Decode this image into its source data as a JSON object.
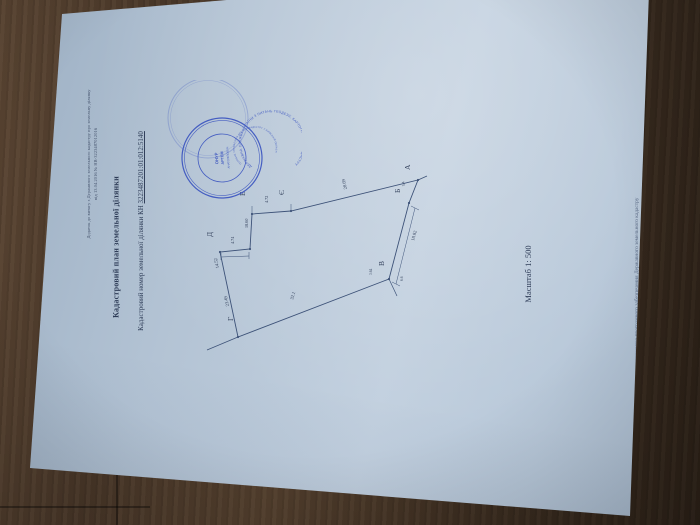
{
  "document": {
    "note_line1": "Додаток до витягу з Державного земельного кадастру про земельну ділянку",
    "note_line2": "від 13.04.2016 № НВ-3223487012016",
    "title": "Кадастровий план земельної ділянки",
    "cadastral_label": "Кадастровий номер земельної ділянки КН",
    "cadastral_number": "3223487201:01:012:5140",
    "scale": "Масштаб 1: 500",
    "footer": "Створено за допомогою програмного забезпечення Державного земельного кадастру"
  },
  "stamp": {
    "outer_text": "ДЕРЖАВНА СЛУЖБА УКРАЇНИ З ПИТАНЬ ГЕОДЕЗІЇ, КАРТОГРАФІЇ ТА КАДАСТРУ",
    "inner_text": "ГОЛОВНЕ УПРАВЛІННЯ ДЕРЖГЕОКАДАСТРУ У КИЇВСЬКІЙ ОБЛАСТІ",
    "center_line1": "ОНУР",
    "center_line2": "АРТЕМ",
    "center_line3": "АНАТОЛІЙОВИЧ",
    "color": "#2b46bd"
  },
  "diagram": {
    "vertices": {
      "a": "А",
      "b": "Б",
      "v": "В",
      "g": "Г",
      "d": "Д",
      "e": "Е",
      "ye": "Є"
    },
    "dims": {
      "ea": "28.69",
      "ab": "5.4",
      "bv": "18.02",
      "vg": "32.1",
      "gd_upper": "14.52",
      "gd_lower": "23.49",
      "de": "4.74",
      "e_seg": "18.60",
      "ee": "4.72",
      "v_left": "3.64",
      "v_right": "6.6"
    }
  },
  "colors": {
    "wood": "#4a3829",
    "paper": "#b3c3d4",
    "ink": "#33415c",
    "plot_line": "#3d5278",
    "stamp_blue": "#2b46bd"
  }
}
